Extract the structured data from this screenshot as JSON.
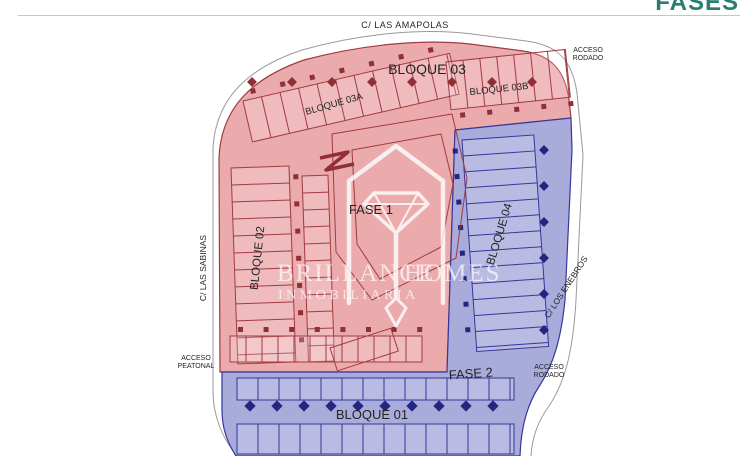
{
  "header": {
    "title": "FASES"
  },
  "plan": {
    "streets": {
      "top": "C/ LAS AMAPOLAS",
      "left": "C/ LAS SABINAS",
      "right": "C/ LOS ENEBROS"
    },
    "access": {
      "top_right_line1": "ACCESO",
      "top_right_line2": "RODADO",
      "bottom_left_line1": "ACCESO",
      "bottom_left_line2": "PEATONAL",
      "bottom_right_line1": "ACCESO",
      "bottom_right_line2": "RODADO"
    },
    "phase1": {
      "label": "FASE 1"
    },
    "phase2": {
      "label": "FASE 2"
    },
    "blocks": {
      "b01": "BLOQUE 01",
      "b02": "BLOQUE 02",
      "b03": "BLOQUE 03",
      "b03a": "BLOQUE 03A",
      "b03b": "BLOQUE 03B",
      "b04": "BLOQUE 04"
    }
  },
  "watermark": {
    "brand_word1": "BRILLANCE",
    "brand_word2": "HOMES",
    "tagline": "INMOBILIARIA",
    "logo": "house-diamond-icon"
  },
  "colors": {
    "title": "#27806f",
    "phase1_fill": "#ebabad",
    "phase1_line": "#a03b41",
    "phase1_symbol": "#8f2f36",
    "phase2_fill": "#a9abdb",
    "phase2_line": "#34379b",
    "phase2_symbol": "#23267e",
    "boundary_line": "#9a9a9a"
  }
}
